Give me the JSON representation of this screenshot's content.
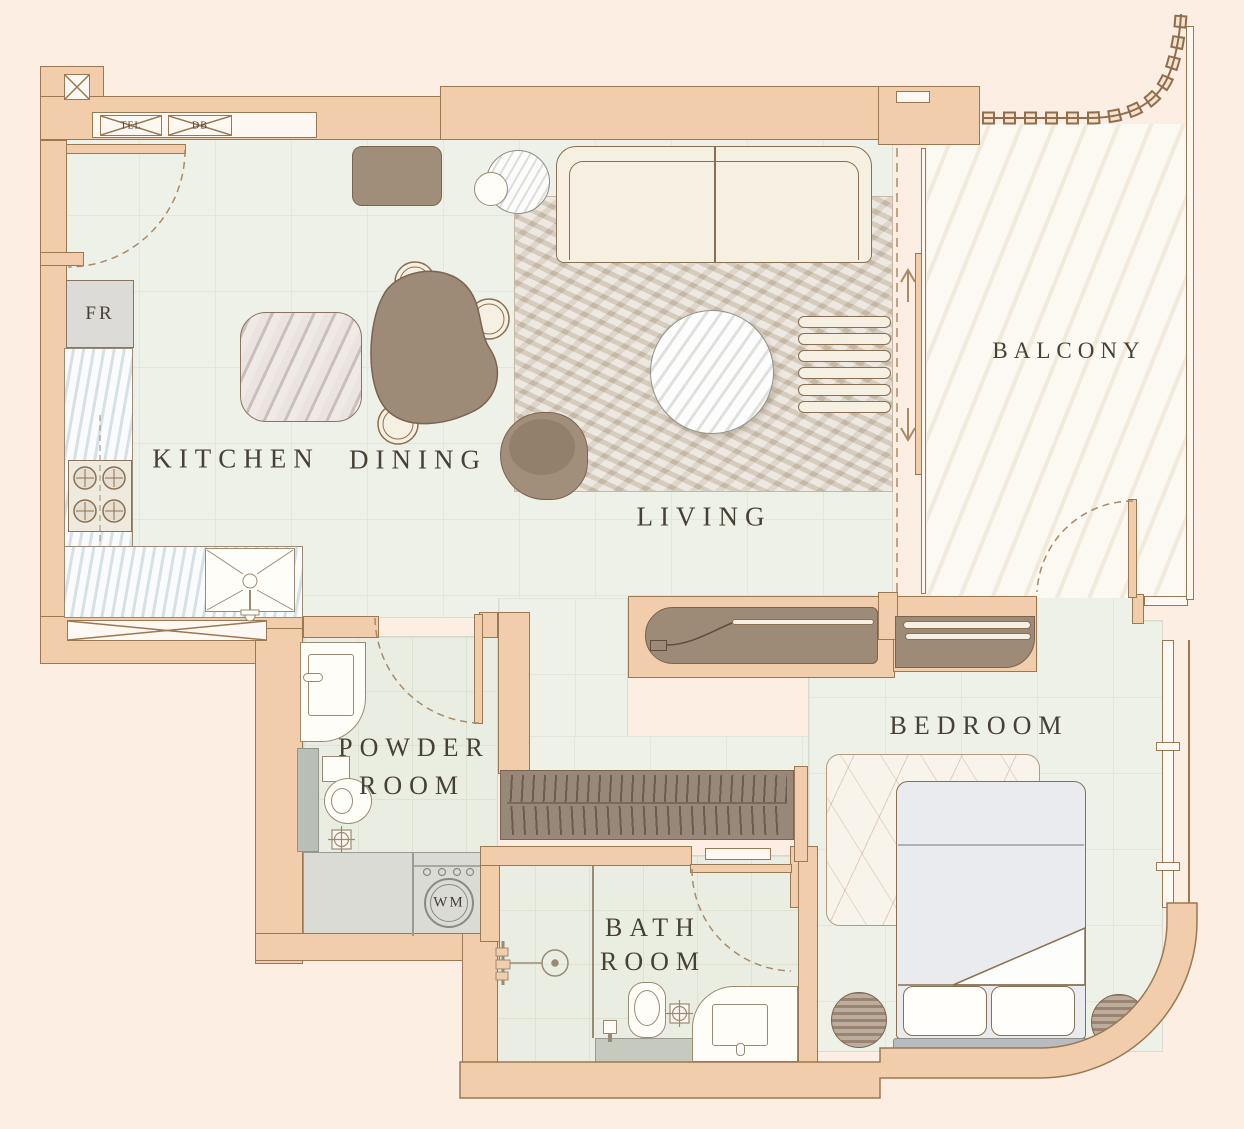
{
  "rooms": {
    "kitchen": {
      "label": "KITCHEN"
    },
    "dining": {
      "label": "DINING"
    },
    "living": {
      "label": "LIVING"
    },
    "balcony": {
      "label": "BALCONY"
    },
    "bedroom": {
      "label": "BEDROOM"
    },
    "powder": {
      "line1": "POWDER",
      "line2": "ROOM"
    },
    "bath": {
      "line1": "BATH",
      "line2": "ROOM"
    }
  },
  "appliances": {
    "fridge": "FR",
    "washer": "WM",
    "tel": "TEL",
    "db": "DB"
  },
  "colors": {
    "background": "#fceee2",
    "wall": "#f2cdab",
    "wall_line": "#9a7853",
    "floor_tile": "#eef1e8",
    "bath_tile": "#eaeee2",
    "balcony_floor": "#f8f2e6",
    "laundry_gray": "#dbdbd6",
    "wood": "#a08d7a",
    "cream": "#f6f0e2",
    "text": "#474135"
  }
}
